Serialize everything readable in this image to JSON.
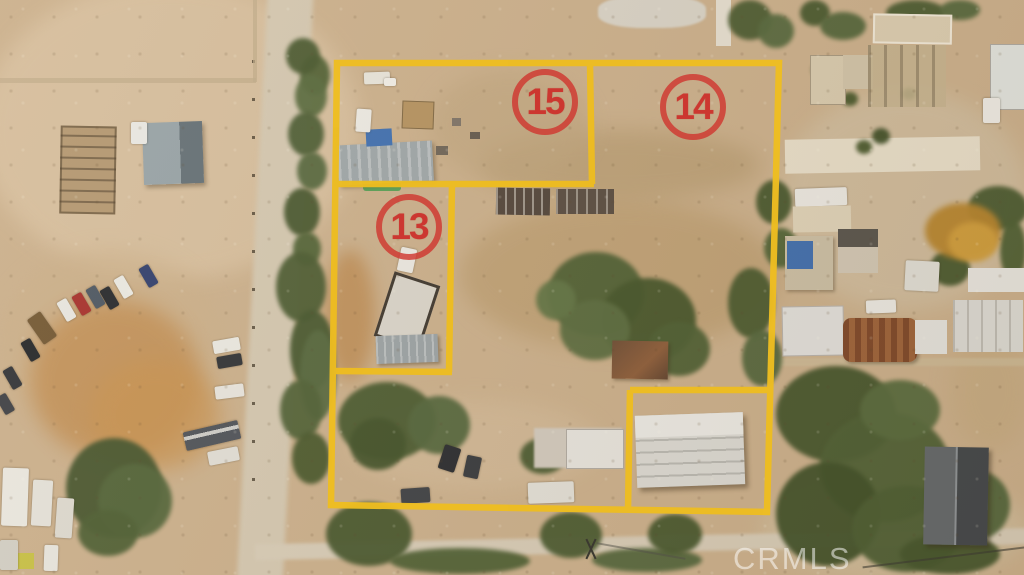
{
  "overlay": {
    "boundary_color": "#eebd20",
    "label_color": "#cf3730",
    "parcels": [
      {
        "id": "parcel-15",
        "label": "15"
      },
      {
        "id": "parcel-14",
        "label": "14"
      },
      {
        "id": "parcel-13",
        "label": "13"
      }
    ]
  },
  "watermark": {
    "text": "CRMLS",
    "color": "#ffffff"
  }
}
